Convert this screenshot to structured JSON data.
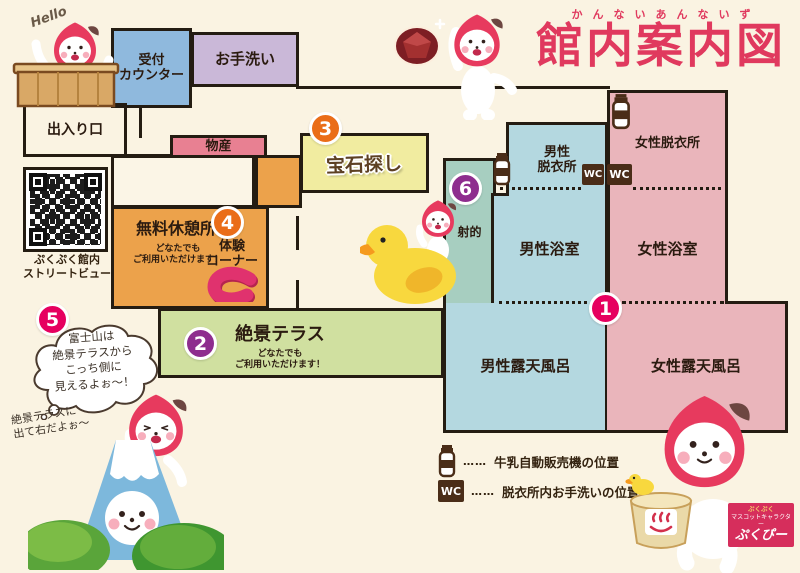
{
  "title": {
    "furigana": "かんないあんないず",
    "main": "館内案内図"
  },
  "greeting": "Hello",
  "wc_label": "WC",
  "rooms": {
    "reception": "受付\nカウンター",
    "restroom": "お手洗い",
    "entrance": "出入り口",
    "products": "物産",
    "free_rest_area": "無料休憩所",
    "free_rest_area_note": "どなたでも\nご利用いただけます！",
    "experience_corner": "体験\nコーナー",
    "gem_hunting": "宝石探し",
    "shooting": "射的",
    "mens_dressing": "男性\n脱衣所",
    "womens_dressing": "女性脱衣所",
    "mens_bath": "男性浴室",
    "womens_bath": "女性浴室",
    "mens_open_air_bath": "男性露天風呂",
    "womens_open_air_bath": "女性露天風呂",
    "terrace": "絶景テラス",
    "terrace_note": "どなたでも\nご利用いただけます！"
  },
  "badges": [
    "1",
    "2",
    "3",
    "4",
    "5",
    "6"
  ],
  "qr_caption": "ぷくぷく館内\nストリートビュー",
  "speech_bubble": "富士山は\n絶景テラスから\nこっち側に\n見えるよぉ〜！",
  "speech_note": "絶景テラスに\n出て右だよぉ〜",
  "legend": {
    "dots": "……",
    "milk": "牛乳自動販売機の位置",
    "wc": "脱衣所内お手洗いの位置"
  },
  "mascot_tag": {
    "brand": "ぷくぷく",
    "role": "マスコットキャラクター",
    "name": "ぷくぴー"
  },
  "colors": {
    "background": "#faf3e2",
    "title": "#e0395e",
    "wall": "#241c12",
    "reception": "#8fb9dd",
    "restroom": "#cab8d8",
    "products": "#e88092",
    "rest_area": "#eca24b",
    "gem": "#f1eca0",
    "shooting": "#a7cec0",
    "mens_blue": "#b4d8e0",
    "womens_pink": "#eab5bb",
    "terrace": "#d0e0a0",
    "badge_pink": "#e6005f",
    "badge_purple": "#8e2d8e",
    "badge_orange": "#ea6d18",
    "mascot_hood": "#e73a5e"
  }
}
